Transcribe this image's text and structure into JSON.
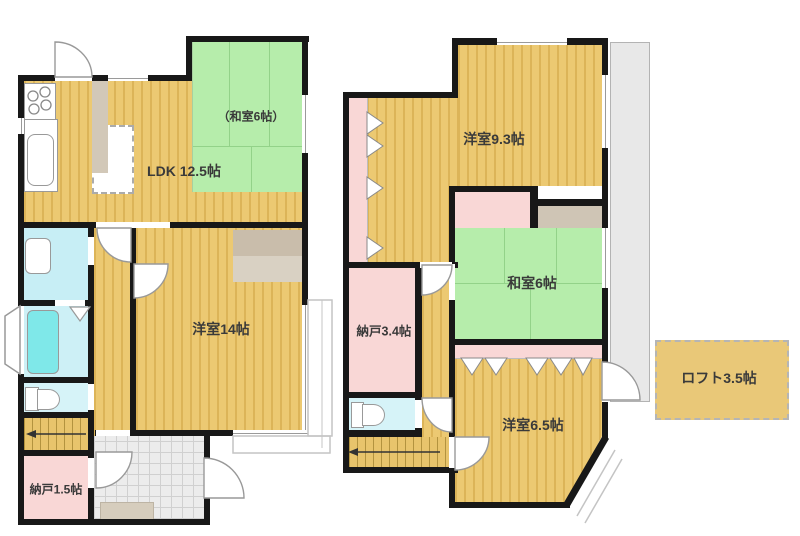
{
  "title": "floor-plan",
  "floor1": {
    "washitsu": "（和室6帖）",
    "ldk": "LDK 12.5帖",
    "yoshitsu": "洋室14帖",
    "nando": "納戸1.5帖"
  },
  "floor2": {
    "yoshitsu_large": "洋室9.3帖",
    "washitsu": "和室6帖",
    "nando": "納戸3.4帖",
    "yoshitsu_small": "洋室6.5帖"
  },
  "loft": {
    "label": "ロフト3.5帖"
  },
  "palette": {
    "wall": "#181818",
    "wood_floor": "#ecc972",
    "wood_stripe": "#dcb458",
    "tatami_green": "#b6edab",
    "closet_pink": "#f9d7d6",
    "washroom_cyan": "#c7eef5",
    "bathtub_cyan": "#7fe8e9",
    "entrance_gray": "#ececec",
    "closet_beige": "#d2c8b8",
    "balcony_gray": "#e8e8e8"
  }
}
